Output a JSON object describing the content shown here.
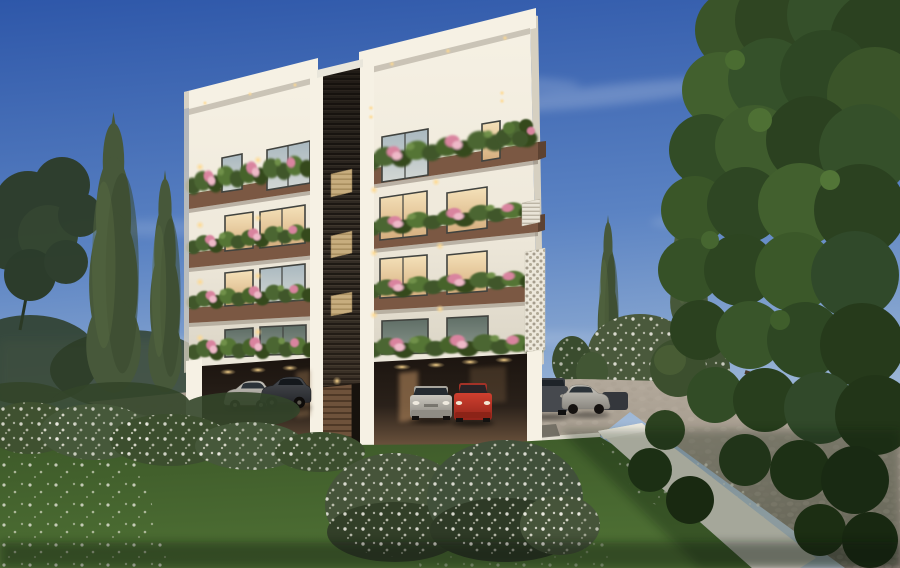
{
  "scene": {
    "type": "architectural-exterior-render",
    "time_of_day": "dusk",
    "description": "3D exterior rendering at dusk of a modern white 4-storey apartment building with a dark louvred central core, wood-toned balcony bands planted with shrubs and pink flowers, open ground-floor parking with cars, a cobbled driveway with white kerbs, lawns with white daisies, flowering shrubs, tall cypress trees and a large leafy tree framing the right side under a blue sky with wispy clouds.",
    "building": {
      "storeys_above_ground": 4,
      "ground_floor": "open pilotis car parking with warm recessed lighting",
      "facade": "white render, two blocks separated by a dark horizontal-louvre core",
      "core_feature": "three backlit beige panels and a slatted entrance door",
      "right_side_feature": "white perforated privacy screen and small slatted balcony",
      "balconies": "continuous planters with green shrubs and pink flowers on every level",
      "lighting": "warm facade downlights, wall sconces and lit interiors"
    },
    "vehicles": [
      {
        "type": "sedan",
        "color": "silver",
        "location": "left parking bay"
      },
      {
        "type": "sedan",
        "color": "dark grey",
        "location": "left parking bay"
      },
      {
        "type": "sedan",
        "color": "silver",
        "location": "right parking bay"
      },
      {
        "type": "hatchback",
        "color": "red",
        "location": "right parking bay"
      },
      {
        "type": "suv",
        "color": "dark grey",
        "location": "driveway right of building"
      },
      {
        "type": "sedan",
        "color": "silver",
        "location": "driveway right of building"
      },
      {
        "type": "car",
        "color": "dark",
        "location": "driveway far right, partly hidden"
      }
    ],
    "landscape": {
      "left": [
        "two tall cypress trees",
        "dark deciduous tree silhouette",
        "white-flowering hedge",
        "lawn with daisies"
      ],
      "right": [
        "large leafy foreground tree",
        "two cypress trees",
        "white-flowering shrubs",
        "round clipped bush",
        "white retaining wall"
      ],
      "foreground": [
        "two flowering shrubs",
        "lawn",
        "cobbled driveway with white kerb"
      ]
    },
    "sky": "clear blue with thin cirrus clouds"
  },
  "palette": {
    "sky_top": "#2e57a9",
    "sky_mid": "#5b83c3",
    "sky_low": "#9ab5d6",
    "sky_horizon": "#c3d2de",
    "wall": "#efe9db",
    "wall_bright": "#f6f1e4",
    "wall_shade": "#d9d3c4",
    "fascia": "#ece7da",
    "band": "#7b5843",
    "band_dark": "#5d4231",
    "core": "#39322a",
    "core_dark": "#221d17",
    "core_panel": "#c7ad7e",
    "frame": "#41433f",
    "glass_warm_a": "#f5e2ba",
    "glass_warm_b": "#d5ad7d",
    "glass_cool_a": "#a9b8bf",
    "glass_cool_b": "#d3d7d4",
    "glass_dark_a": "#5f6e66",
    "glass_dark_b": "#8b978d",
    "light_warm": "#ffd98f",
    "park_a": "#19130e",
    "park_b": "#70563f",
    "pave_a": "#b2a89a",
    "pave_b": "#8d8578",
    "curb": "#e5e1d5",
    "grass_a": "#3a5527",
    "grass_b": "#4e7034",
    "foliage_dark": "#2f4323",
    "foliage_mid": "#3f5a2b",
    "foliage_light": "#547536",
    "cypress": "#47583a",
    "cypress_dark": "#39482e",
    "blossom": "#efede2",
    "flower_pink": "#d9849f",
    "flower_pink_light": "#eeb9c8",
    "car_silver_a": "#c9c6be",
    "car_silver_b": "#8a8780",
    "car_dark": "#3f4246",
    "car_red_a": "#d0402f",
    "car_red_b": "#93241a",
    "car_suv": "#46494e"
  }
}
